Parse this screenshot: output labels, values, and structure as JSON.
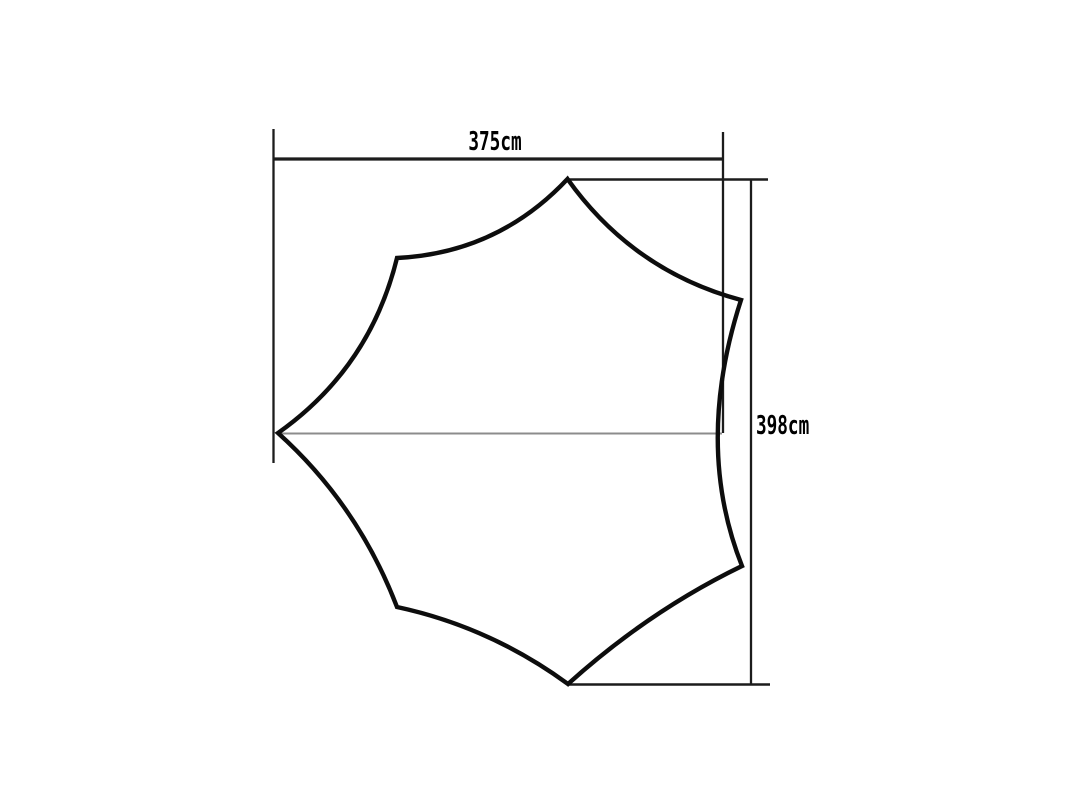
{
  "page": {
    "background": "#ffffff",
    "description": "Technical dimension diagram of a seven-point star-shaped tarp outline with concave edges"
  },
  "labels": {
    "width": "375cm",
    "height": "398cm"
  },
  "colors": {
    "outline": "#0d0d0d",
    "dimension": "#1c1c1c",
    "centerline": "#8c8c8c",
    "text": "#000000"
  },
  "shape": {
    "stroke_width": 4.4,
    "path_d": "M 567.5 179 Q 633 271 741 300 Q 694 445 742 566 Q 649 611 568 684 Q 490 627 397 607 Q 358 505 278 433 Q 370 368 397 258 Q 498 253 567.5 179 Z",
    "vertices": [
      {
        "name": "top-point",
        "x": 567.5,
        "y": 179
      },
      {
        "name": "upper-right-point",
        "x": 741,
        "y": 300
      },
      {
        "name": "lower-right-point",
        "x": 742,
        "y": 566
      },
      {
        "name": "bottom-point",
        "x": 568,
        "y": 684
      },
      {
        "name": "lower-left-point",
        "x": 397,
        "y": 607
      },
      {
        "name": "left-point",
        "x": 278,
        "y": 433
      },
      {
        "name": "upper-left-point",
        "x": 397,
        "y": 258
      }
    ]
  },
  "lines": [
    {
      "name": "left-extension-line",
      "x1": 273.5,
      "y1": 129,
      "x2": 273.5,
      "y2": 463,
      "width": 2.3,
      "color": "dimension"
    },
    {
      "name": "width-dimension-line",
      "x1": 272.5,
      "y1": 159,
      "x2": 723,
      "y2": 159,
      "width": 3.2,
      "color": "dimension"
    },
    {
      "name": "right-extension-line",
      "x1": 723,
      "y1": 132,
      "x2": 723,
      "y2": 433,
      "width": 2.3,
      "color": "dimension"
    },
    {
      "name": "top-point-extension-line",
      "x1": 568,
      "y1": 179.5,
      "x2": 768,
      "y2": 179.5,
      "width": 2.5,
      "color": "dimension"
    },
    {
      "name": "height-dimension-line",
      "x1": 751,
      "y1": 179,
      "x2": 751,
      "y2": 685,
      "width": 2.3,
      "color": "dimension"
    },
    {
      "name": "bottom-extension-line",
      "x1": 568,
      "y1": 684.5,
      "x2": 770,
      "y2": 684.5,
      "width": 2.5,
      "color": "dimension"
    },
    {
      "name": "center-line",
      "x1": 278,
      "y1": 433.5,
      "x2": 722,
      "y2": 433.5,
      "width": 2,
      "color": "centerline"
    }
  ]
}
